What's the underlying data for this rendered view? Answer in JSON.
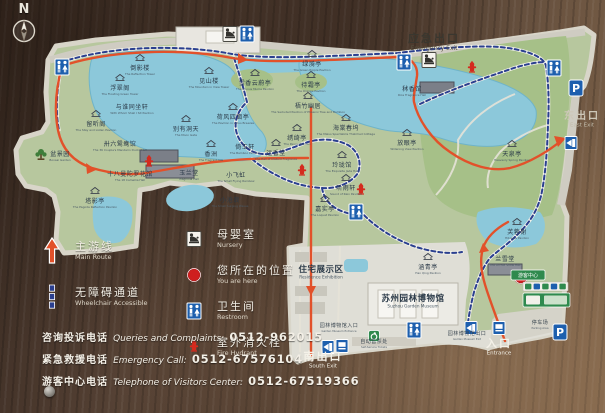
{
  "compass": {
    "label": "N"
  },
  "colors": {
    "wood": "#554134",
    "panel": "#b7c79e",
    "panel_edge": "#d8d5c9",
    "water": "#8cc8da",
    "lawn": "#a6c088",
    "route_main": "#e2512a",
    "route_accessible": "#2a3f8f",
    "museum": "#dfded6",
    "label_dark": "#2c3b49",
    "you_are_here": "#cf1f1f"
  },
  "legend": {
    "left": [
      {
        "type": "main-route",
        "zh": "主游线",
        "en": "Main Route"
      },
      {
        "type": "wheelchair",
        "zh": "无障碍通道",
        "en": "Wheelchair Accessible"
      }
    ],
    "mid": [
      {
        "type": "nursery",
        "zh": "母婴室",
        "en": "Nursery"
      },
      {
        "type": "you-are-here",
        "zh": "您所在的位置",
        "en": "You are here"
      },
      {
        "type": "restroom",
        "zh": "卫生间",
        "en": "Restroom"
      },
      {
        "type": "fire-hydrant",
        "zh": "室外消火栓",
        "en": "Fire Hydrant"
      }
    ]
  },
  "phones": [
    {
      "zh": "咨询投诉电话",
      "en": "Queries and Complaints:",
      "num": "0512-962015"
    },
    {
      "zh": "紧急救援电话",
      "en": "Emergency Call:",
      "num": "0512-67576104"
    },
    {
      "zh": "游客中心电话",
      "en": "Telephone of Visitors Center:",
      "num": "0512-67519366"
    }
  ],
  "map": {
    "parking_label": "P",
    "vc_sign": {
      "zh": "游客中心",
      "en": "Visitor Center"
    },
    "labels": [
      {
        "zh": "倒影楼",
        "en": "The Reflection Tower",
        "x": 140,
        "y": 70,
        "k": "pav",
        "pav": 1
      },
      {
        "zh": "浮翠阁",
        "en": "The Floating Green Tower",
        "x": 120,
        "y": 90,
        "k": "pav",
        "pav": 1
      },
      {
        "zh": "与谁同坐轩",
        "en": "With Whom Shall I Sit Pavilion",
        "x": 132,
        "y": 109,
        "k": "pav",
        "pav": 0
      },
      {
        "zh": "见山楼",
        "en": "The Mountain in View Tower",
        "x": 209,
        "y": 83,
        "k": "pav",
        "pav": 1
      },
      {
        "zh": "留听阁",
        "en": "The Stay and Listen Pavilion",
        "x": 96,
        "y": 126,
        "k": "pav",
        "pav": 1
      },
      {
        "zh": "别有洞天",
        "en": "The Moon Gate",
        "x": 186,
        "y": 131,
        "k": "pav",
        "pav": 1
      },
      {
        "zh": "荷风四面亭",
        "en": "The Pavilion in Lotus Breezes",
        "x": 233,
        "y": 119,
        "k": "pav",
        "pav": 1
      },
      {
        "zh": "卅六鸳鸯馆",
        "en": "The 36 Couple's Mandarin Ducks Hall",
        "x": 120,
        "y": 146,
        "k": "pav",
        "pav": 0
      },
      {
        "zh": "十八曼陀罗花馆",
        "en": "The 18 Camellia Hall",
        "x": 130,
        "y": 176,
        "k": "pav",
        "pav": 0
      },
      {
        "zh": "塔影亭",
        "en": "The Pagoda Reflection Pavilion",
        "x": 95,
        "y": 203,
        "k": "pav",
        "pav": 1
      },
      {
        "zh": "玉兰堂",
        "en": "Magnolia Hall",
        "x": 189,
        "y": 175,
        "k": "pav",
        "pav": 0
      },
      {
        "zh": "香洲",
        "en": "The Fragrant Isle",
        "x": 211,
        "y": 156,
        "k": "pav",
        "pav": 1
      },
      {
        "zh": "小飞虹",
        "en": "The Small Flying Rainbow",
        "x": 236,
        "y": 177,
        "k": "pav",
        "pav": 0
      },
      {
        "zh": "小沧浪",
        "en": "The Small Surging Waves",
        "x": 230,
        "y": 202,
        "k": "pav",
        "pav": 0
      },
      {
        "zh": "倚玉轩",
        "en": "The Bamboo Pavilion",
        "x": 245,
        "y": 149,
        "k": "pav",
        "pav": 0
      },
      {
        "zh": "远香堂",
        "en": "The Hall of Distant Fragrance",
        "x": 276,
        "y": 155,
        "k": "pav",
        "pav": 1
      },
      {
        "zh": "绣绮亭",
        "en": "The Peony Pavilion",
        "x": 297,
        "y": 140,
        "k": "pav",
        "pav": 1
      },
      {
        "zh": "海棠春坞",
        "en": "The Malus Spectabilis Thatched Cottage",
        "x": 346,
        "y": 130,
        "k": "pav",
        "pav": 1
      },
      {
        "zh": "玲珑馆",
        "en": "The Exquisite Jade Hall",
        "x": 342,
        "y": 167,
        "k": "pav",
        "pav": 1
      },
      {
        "zh": "听雨轩",
        "en": "Sound of Rain Pavilion",
        "x": 346,
        "y": 190,
        "k": "pav",
        "pav": 1
      },
      {
        "zh": "嘉实亭",
        "en": "The Loquat Pavilion",
        "x": 325,
        "y": 211,
        "k": "pav",
        "pav": 1
      },
      {
        "zh": "梧竹幽居",
        "en": "The Secluded Pavilion of Phoenix Tree and Bamboo",
        "x": 308,
        "y": 108,
        "k": "pav",
        "pav": 1
      },
      {
        "zh": "雪香云蔚亭",
        "en": "The Prunus Mume Pavilion",
        "x": 255,
        "y": 85,
        "k": "pav",
        "pav": 1
      },
      {
        "zh": "待霜亭",
        "en": "The Orange Pavilion",
        "x": 311,
        "y": 87,
        "k": "pav",
        "pav": 1
      },
      {
        "zh": "绿漪亭",
        "en": "The Green Ripple Pavilion",
        "x": 312,
        "y": 66,
        "k": "pav",
        "pav": 1
      },
      {
        "zh": "秫香馆",
        "en": "Rice Fragrance Hall",
        "x": 412,
        "y": 91,
        "k": "pav",
        "pav": 0
      },
      {
        "zh": "放眼亭",
        "en": "Widening View Pavilion",
        "x": 407,
        "y": 145,
        "k": "pav",
        "pav": 1
      },
      {
        "zh": "天泉亭",
        "en": "Heavenly Spring Pavilion",
        "x": 512,
        "y": 156,
        "k": "pav",
        "pav": 1
      },
      {
        "zh": "芙蓉榭",
        "en": "Hibiscus Pavilion",
        "x": 517,
        "y": 234,
        "k": "pav",
        "pav": 1
      },
      {
        "zh": "兰雪堂",
        "en": "The Orchid Snow Hall",
        "x": 505,
        "y": 261,
        "k": "pav",
        "pav": 0
      },
      {
        "zh": "涵青亭",
        "en": "Han Qing Pavilion",
        "x": 428,
        "y": 269,
        "k": "pav",
        "pav": 1
      },
      {
        "zh": "盆景园",
        "en": "Bonsai Garden",
        "x": 60,
        "y": 156,
        "k": "pav",
        "pav": 0
      },
      {
        "zh": "住宅展示区",
        "en": "Residence Exhibition",
        "x": 321,
        "y": 272,
        "k": "area",
        "pav": 0
      },
      {
        "zh": "苏州园林博物馆",
        "en": "Suzhou Garden Museum",
        "x": 413,
        "y": 301,
        "k": "area",
        "pav": 0
      },
      {
        "zh": "园林博物馆入口",
        "en": "Garden Museum Entrance",
        "x": 339,
        "y": 327,
        "k": "small",
        "pav": 0
      },
      {
        "zh": "自动售票处",
        "en": "Self-Service Tickets",
        "x": 374,
        "y": 343,
        "k": "small",
        "pav": 0
      },
      {
        "zh": "园林博物馆出口",
        "en": "Garden Museum Exit",
        "x": 467,
        "y": 335,
        "k": "small",
        "pav": 0
      },
      {
        "zh": "停车场",
        "en": "Parking Area",
        "x": 540,
        "y": 324,
        "k": "small",
        "pav": 0
      },
      {
        "zh": "应急出口",
        "en": "Emergency Exit",
        "x": 434,
        "y": 42,
        "k": "gate-dark",
        "pav": 0
      },
      {
        "zh": "东出口",
        "en": "East Exit",
        "x": 582,
        "y": 119,
        "k": "gate-light",
        "pav": 0
      },
      {
        "zh": "南出口",
        "en": "South Exit",
        "x": 323,
        "y": 360,
        "k": "gate-white",
        "pav": 0
      },
      {
        "zh": "入口",
        "en": "Entrance",
        "x": 499,
        "y": 347,
        "k": "gate-white",
        "pav": 0
      }
    ],
    "icons": [
      {
        "t": "restroom",
        "x": 62,
        "y": 67
      },
      {
        "t": "restroom",
        "x": 247,
        "y": 34
      },
      {
        "t": "restroom",
        "x": 404,
        "y": 62
      },
      {
        "t": "restroom",
        "x": 554,
        "y": 68
      },
      {
        "t": "restroom",
        "x": 356,
        "y": 212
      },
      {
        "t": "restroom",
        "x": 414,
        "y": 330
      },
      {
        "t": "nursery",
        "x": 230,
        "y": 34
      },
      {
        "t": "nursery",
        "x": 429,
        "y": 60
      },
      {
        "t": "fire-hydrant",
        "x": 149,
        "y": 162
      },
      {
        "t": "fire-hydrant",
        "x": 302,
        "y": 171
      },
      {
        "t": "fire-hydrant",
        "x": 361,
        "y": 190
      },
      {
        "t": "fire-hydrant",
        "x": 472,
        "y": 68
      },
      {
        "t": "parking",
        "x": 576,
        "y": 88
      },
      {
        "t": "parking",
        "x": 560,
        "y": 332
      },
      {
        "t": "exit-run",
        "x": 571,
        "y": 143
      },
      {
        "t": "exit-run",
        "x": 471,
        "y": 328
      },
      {
        "t": "exit-run",
        "x": 328,
        "y": 347
      },
      {
        "t": "ticket",
        "x": 499,
        "y": 328
      },
      {
        "t": "ticket",
        "x": 342,
        "y": 346
      },
      {
        "t": "accessible",
        "x": 374,
        "y": 336
      },
      {
        "t": "you-are-here",
        "x": 521,
        "y": 277
      },
      {
        "t": "bonsai",
        "x": 41,
        "y": 155
      }
    ]
  }
}
